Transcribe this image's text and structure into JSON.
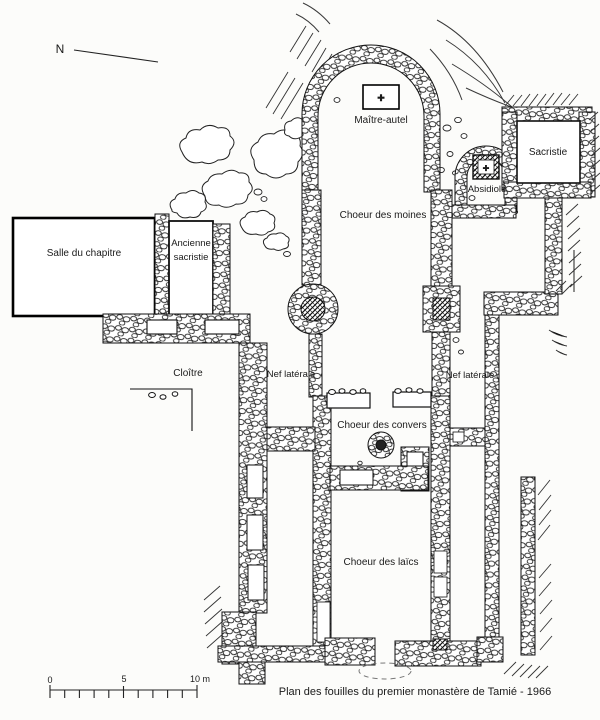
{
  "plan": {
    "compass": {
      "label": "N"
    },
    "labels": {
      "maitre_autel": "Maître-autel",
      "choeur_des_moines": "Choeur des moines",
      "absidiole": "Absidiole",
      "sacristie": "Sacristie",
      "salle_du_chapitre": "Salle du chapitre",
      "ancienne_sacristie_line1": "Ancienne",
      "ancienne_sacristie_line2": "sacristie",
      "cloitre": "Cloître",
      "nef_laterale_gauche": "Nef latérale",
      "nef_laterale_droite": "Nef latérale",
      "choeur_des_convers": "Choeur des convers",
      "choeur_des_laics": "Choeur des laïcs"
    },
    "crosses": {
      "maitre_autel": "✚",
      "absidiole": "✚"
    },
    "scale_bar": {
      "tick0": "0",
      "tick5": "5",
      "tick10": "10 m"
    },
    "caption": "Plan des fouilles du premier monastère de Tamié - 1966",
    "colors": {
      "ink": "#1a1a1a",
      "paper": "#fcfcfa"
    }
  }
}
